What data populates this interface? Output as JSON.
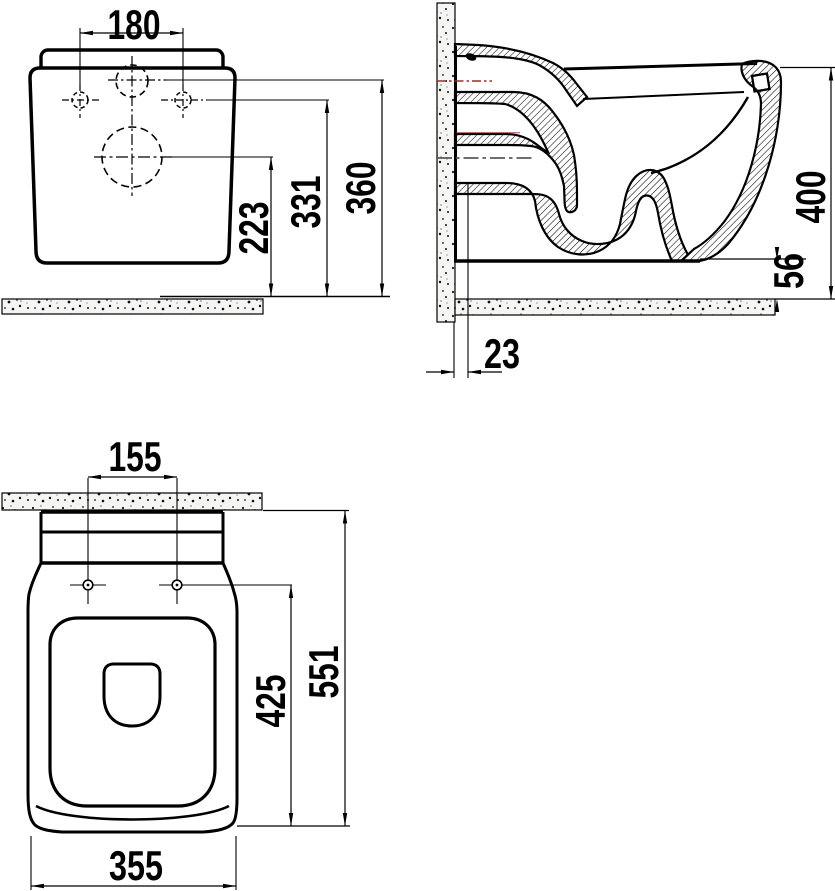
{
  "drawing": {
    "title": "wall-hung-toilet-dimension-drawing",
    "dimensions": {
      "front_view": {
        "fixing_hole_spacing": "180",
        "drain_center_height": "223",
        "fixing_holes_height": "331",
        "water_inlet_height": "360"
      },
      "side_view": {
        "overall_height": "400",
        "bottom_clearance": "56",
        "wall_offset": "23"
      },
      "top_view": {
        "seat_hole_spacing": "155",
        "holes_to_front_depth": "425",
        "overall_depth": "551",
        "overall_width": "355"
      }
    },
    "colors": {
      "line": "#000000",
      "inlet_centerline": "#992c2c",
      "outlet_centerline": "#5a5a5a",
      "concrete_fill": "#f5f5f3"
    }
  }
}
